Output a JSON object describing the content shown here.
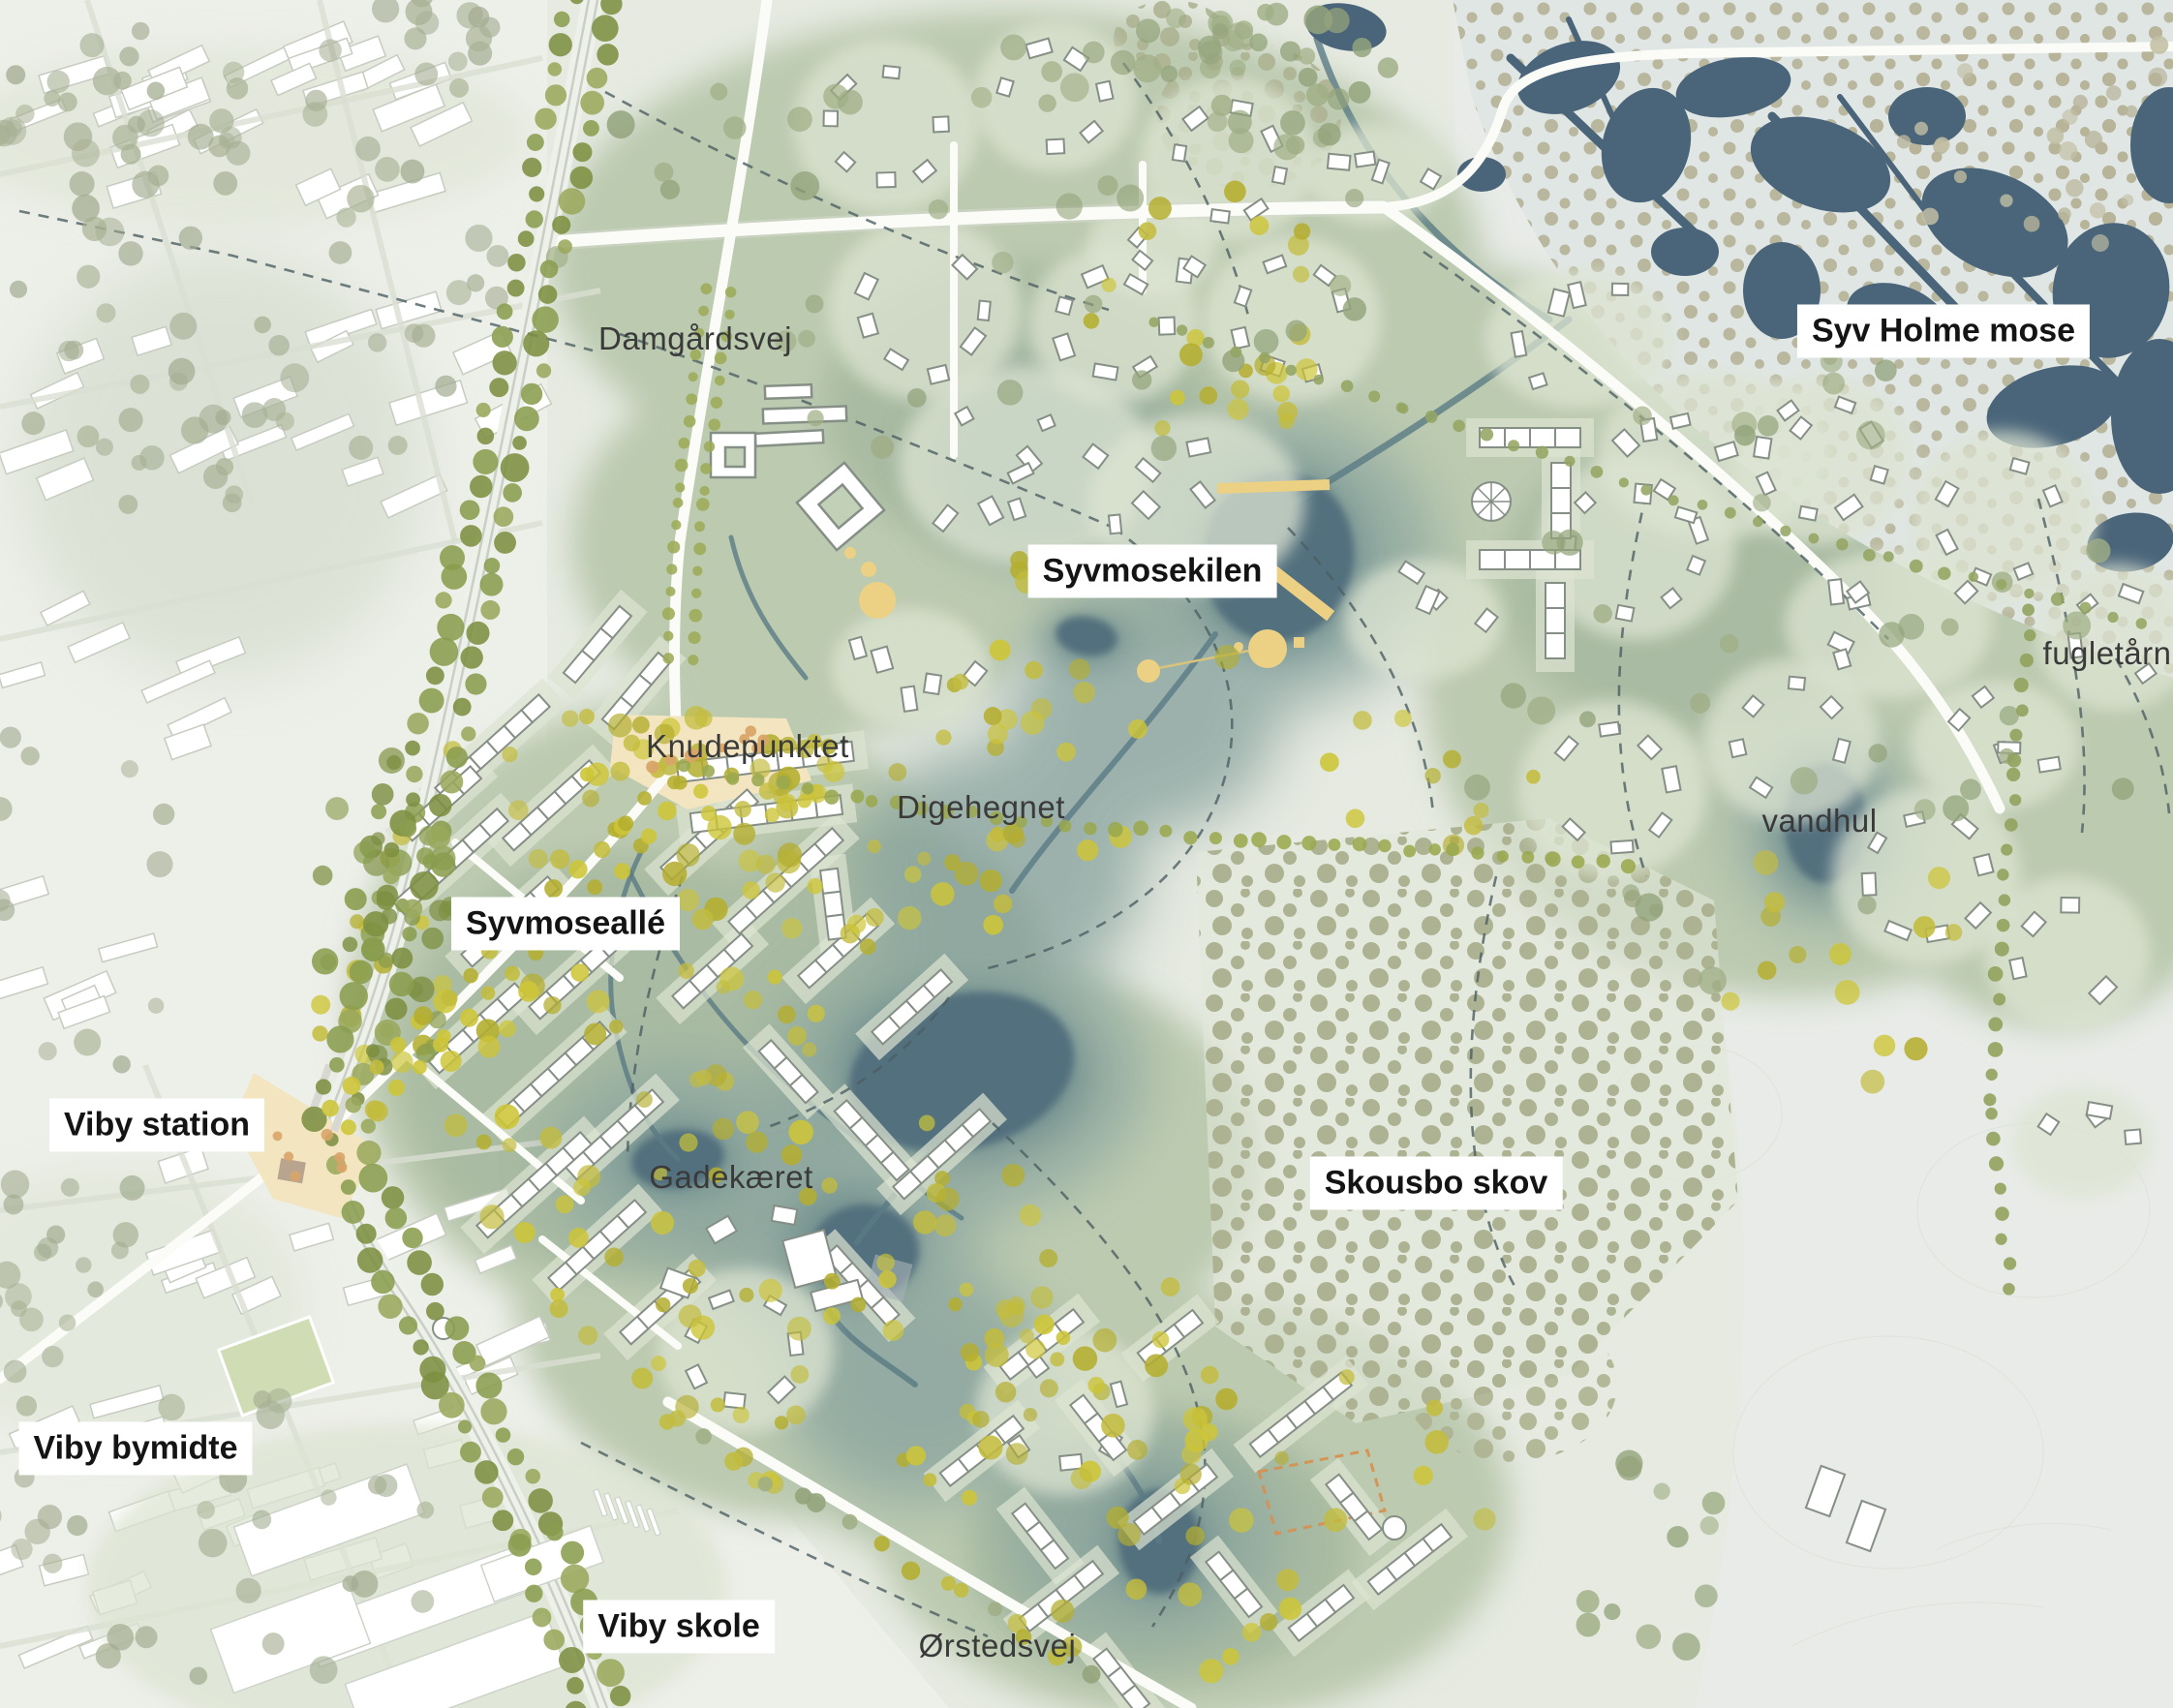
{
  "map": {
    "title": "Viby / Syvmosekilen masterplan",
    "labels": {
      "damgaardsvej": {
        "text": "Damgårdsvej",
        "style": "plain"
      },
      "syv_holme_mose": {
        "text": "Syv Holme mose",
        "style": "boxed"
      },
      "syvmosekilen": {
        "text": "Syvmosekilen",
        "style": "boxed"
      },
      "fugletaarn": {
        "text": "fugletårn",
        "style": "plain"
      },
      "knudepunktet": {
        "text": "Knudepunktet",
        "style": "plain"
      },
      "digehegnet": {
        "text": "Digehegnet",
        "style": "plain"
      },
      "vandhul": {
        "text": "vandhul",
        "style": "plain"
      },
      "syvmosealle": {
        "text": "Syvmoseallé",
        "style": "boxed"
      },
      "viby_station": {
        "text": "Viby station",
        "style": "boxed"
      },
      "gadekaeret": {
        "text": "Gadekæret",
        "style": "plain"
      },
      "skousbo_skov": {
        "text": "Skousbo skov",
        "style": "boxed"
      },
      "viby_bymidte": {
        "text": "Viby bymidte",
        "style": "boxed"
      },
      "viby_skole": {
        "text": "Viby skole",
        "style": "boxed"
      },
      "oerstedsvej": {
        "text": "Ørstedsvej",
        "style": "plain"
      }
    }
  },
  "palette": {
    "base": "#e6eae1",
    "town_bg": "#edefe9",
    "field": "#bccab0",
    "field_dark": "#a9bba2",
    "cell": "#dde4d2",
    "wet_soft": "#8aa49f",
    "wet_mid": "#6d8b8b",
    "pond": "#52707e",
    "mose_dark": "#4a657a",
    "mose_bg": "#e0e6e4",
    "mose_dot": "#b7b49a",
    "forest_dot": "#adb392",
    "tree_sage": "#9fae85",
    "tree_olive": "#8a9d4e",
    "tree_yellow": "#c3bc3d",
    "tree_town": "#a2ab90",
    "road": "#fbfcf8",
    "plaza": "#f2e5c0",
    "accent_yellow": "#ecd184",
    "accent_orange": "#d78f4e",
    "dash": "#4c5f63",
    "bldg_stroke": "#868f86",
    "town_stroke": "#c6ccc0",
    "label_text": "#141414",
    "label_plain": "#3a3a3a"
  }
}
